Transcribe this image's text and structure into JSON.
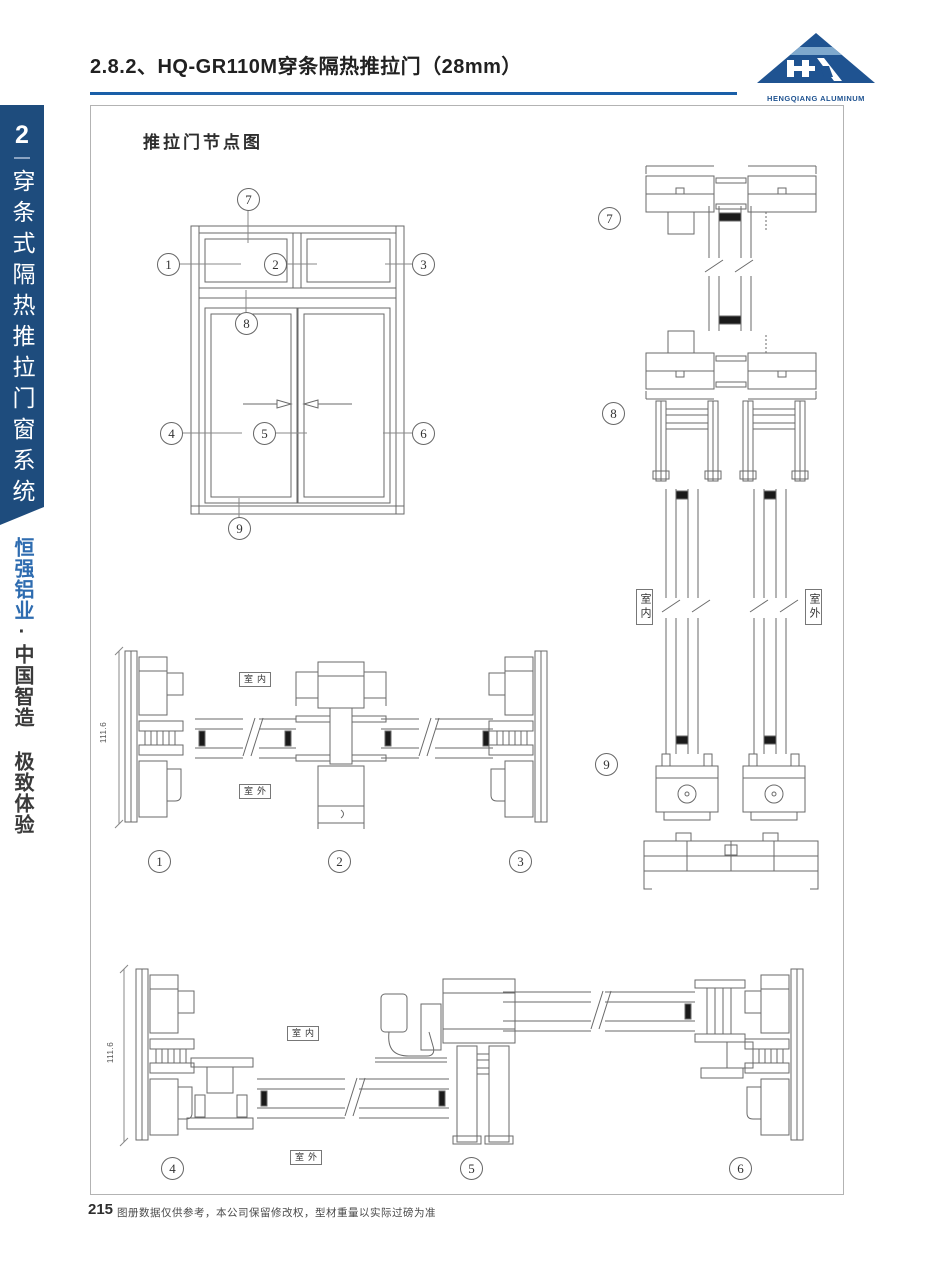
{
  "header": {
    "title": "2.8.2、HQ-GR110M穿条隔热推拉门（28mm）",
    "logo_text": "HENGQIANG ALUMINUM"
  },
  "sidebar": {
    "chapter_number": "2",
    "chapter_title": "穿条式隔热推拉门窗系统",
    "brand_name": "恒强铝业",
    "slogan": "·中国智造 极致体验"
  },
  "drawing": {
    "title": "推拉门节点图",
    "indoor_label": "室内",
    "outdoor_label": "室外",
    "dimension_left": "111.6",
    "dimension_bottom": "111.6",
    "callouts": {
      "c1": "1",
      "c2": "2",
      "c3": "3",
      "c4": "4",
      "c5": "5",
      "c6": "6",
      "c7": "7",
      "c8": "8",
      "c9": "9"
    }
  },
  "footer": {
    "page_number": "215",
    "disclaimer": "图册数据仅供参考，本公司保留修改权，型材重量以实际过磅为准"
  },
  "colors": {
    "sidebar_blue": "#1e4c7d",
    "rule_blue": "#1a5fa8",
    "logo_blue": "#1f5391",
    "brand_blue": "#2e6cb0",
    "line_gray": "#6a6a6a"
  }
}
